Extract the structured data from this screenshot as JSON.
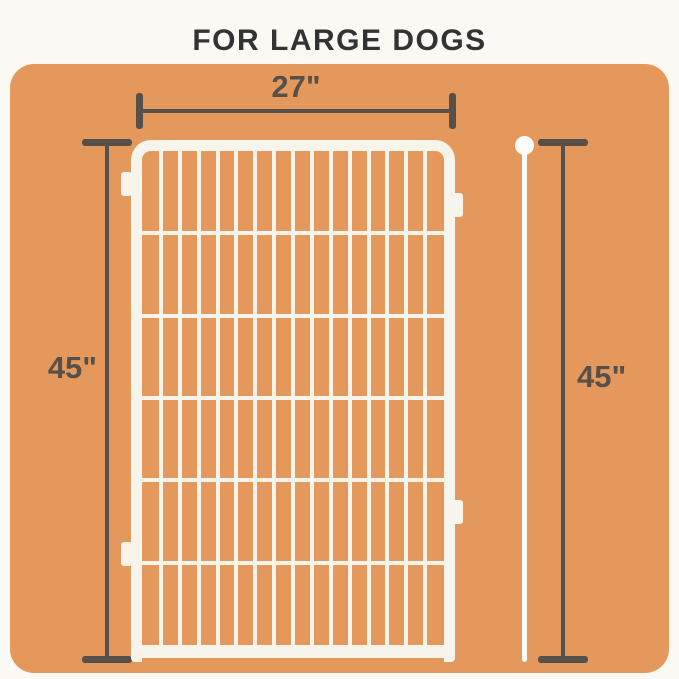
{
  "title": "FOR LARGE DOGS",
  "dimensions": {
    "width": {
      "label": "27\""
    },
    "height_left": {
      "label": "45\""
    },
    "height_right": {
      "label": "45\""
    }
  },
  "panel": {
    "vertical_bars": 15,
    "horizontal_wires": 5
  },
  "colors": {
    "page-bg": "#FBF9F4",
    "board-orange": "#E5985C",
    "panel-white": "#F7F4EC",
    "rod-white": "#FDFCF8",
    "dim-gray": "#57504A",
    "title-color": "#333333"
  }
}
